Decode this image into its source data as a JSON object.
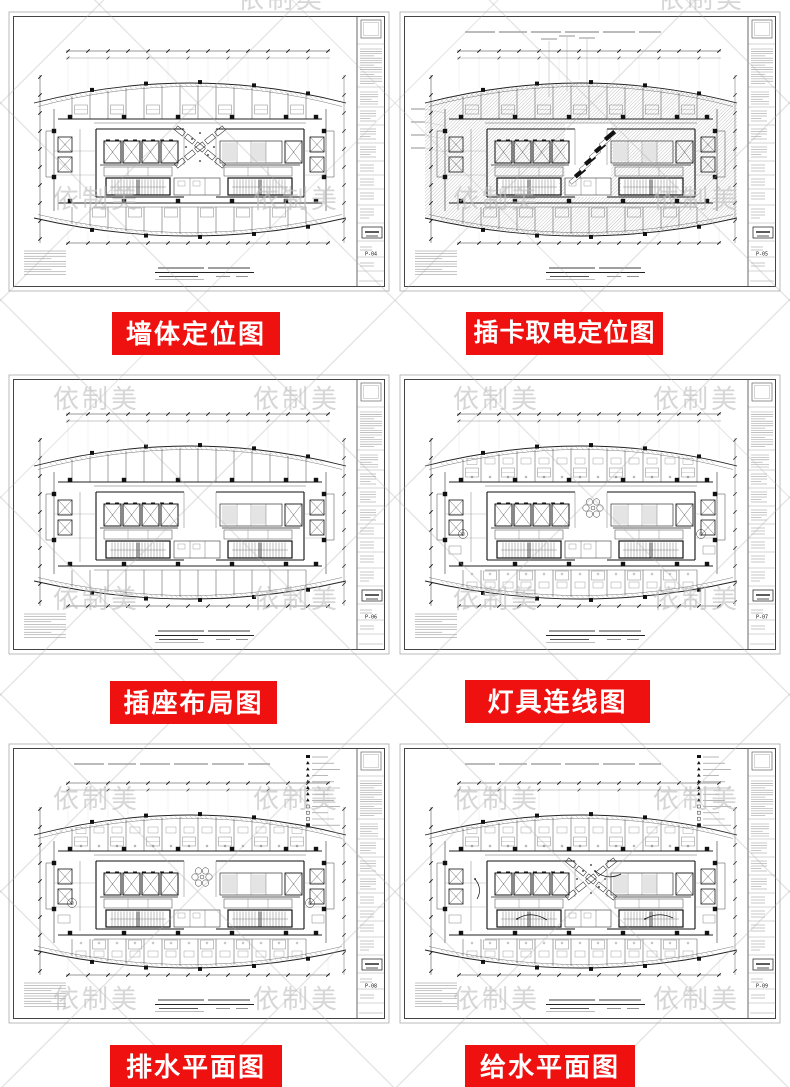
{
  "colors": {
    "banner_red": "#ef1010",
    "banner_text": "#ffffff",
    "watermark": "#bdbdbd"
  },
  "watermark": {
    "text": "依制美"
  },
  "panels": [
    {
      "label": "墙体定位图",
      "sheet_no": "P-04",
      "features": {
        "center_x": true,
        "density": 1
      }
    },
    {
      "label": "插卡取电定位图",
      "sheet_no": "P-05",
      "features": {
        "hatch": true,
        "top_note": true,
        "diag_stair": true,
        "leaders": true,
        "density": 1
      }
    },
    {
      "label": "插座布局图",
      "sheet_no": "P-06",
      "features": {
        "density": 0
      }
    },
    {
      "label": "灯具连线图",
      "sheet_no": "P-07",
      "features": {
        "circles": true,
        "density": 2
      }
    },
    {
      "label": "排水平面图",
      "sheet_no": "P-08",
      "features": {
        "legend": true,
        "top_note": true,
        "circles": true,
        "density": 2
      }
    },
    {
      "label": "给水平面图",
      "sheet_no": "P-09",
      "features": {
        "legend": true,
        "top_note": true,
        "center_x": true,
        "squiggles": true,
        "density": 2
      }
    }
  ]
}
